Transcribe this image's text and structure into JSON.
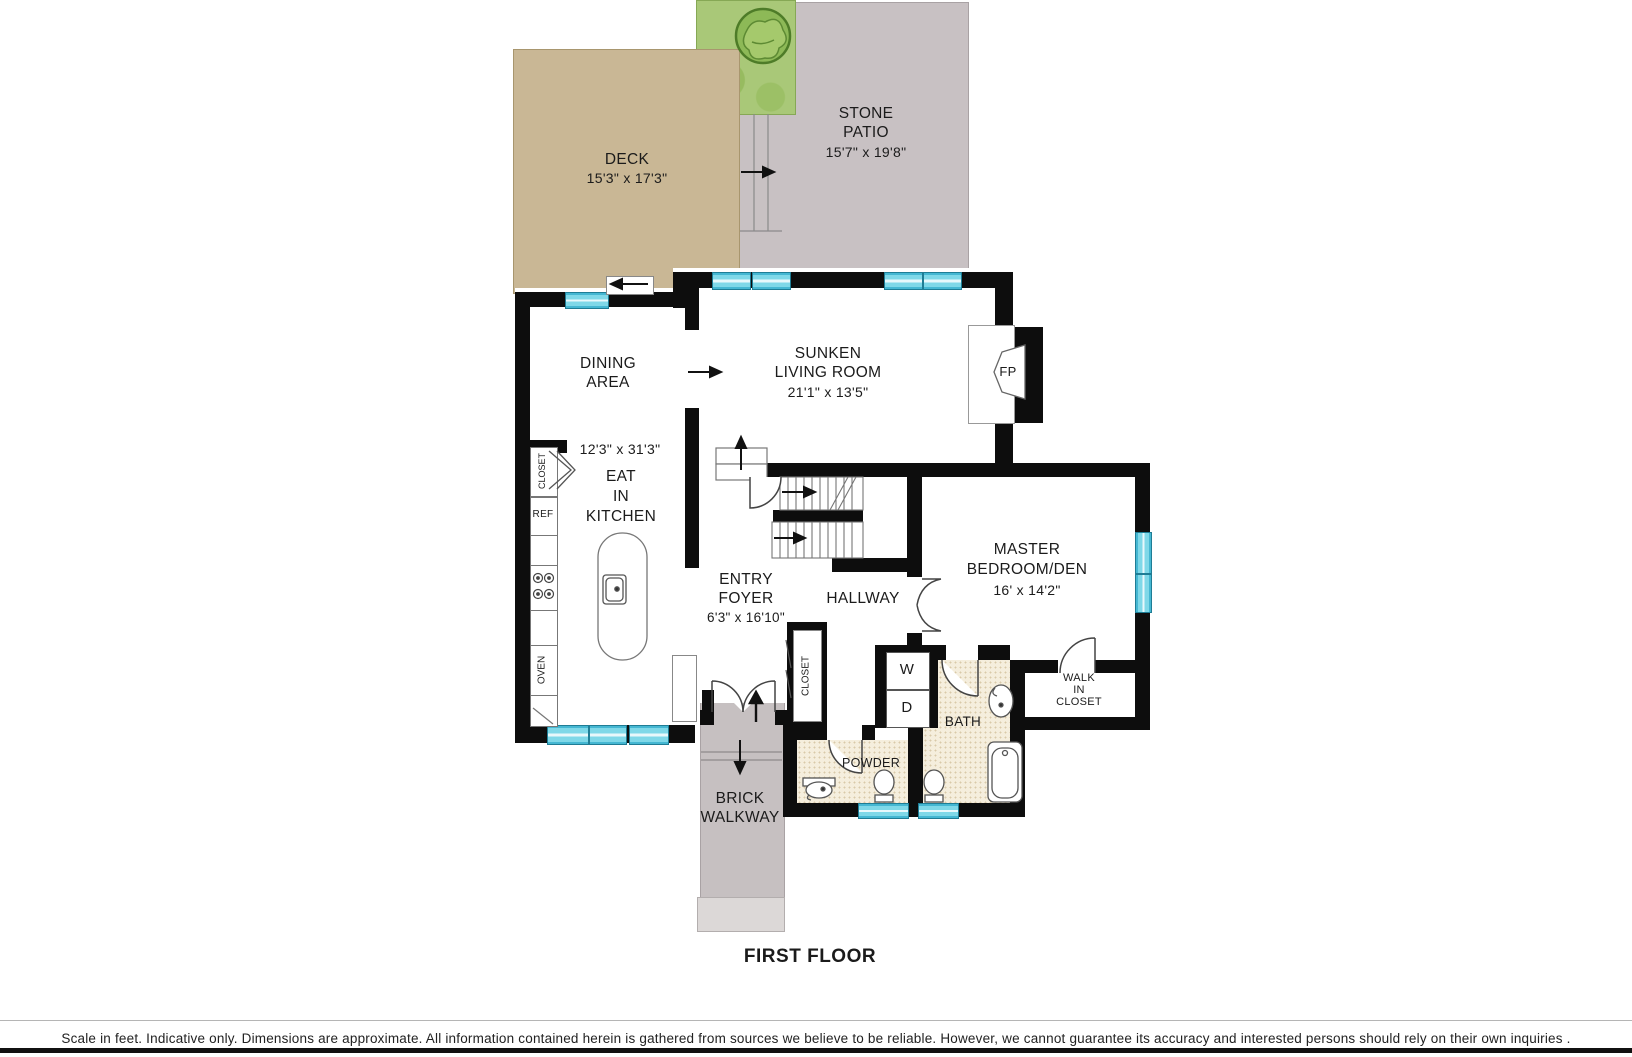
{
  "plan_title": "FIRST FLOOR",
  "disclaimer": "Scale in feet. Indicative only. Dimensions are approximate. All information contained herein is gathered from sources we believe to be reliable. However, we cannot guarantee its accuracy and interested persons should rely on their own inquiries .",
  "colors": {
    "wall": "#0d0d0d",
    "window": "#7fd8e8",
    "deck": "#c9b795",
    "patio": "#c8c1c3",
    "grass": "#a9c878",
    "walkway": "#c6c0c1",
    "bath_tile": "#f5eedd"
  },
  "areas": {
    "deck": {
      "name": "DECK",
      "dims": "15'3\" x 17'3\""
    },
    "stone_patio": {
      "lines": [
        "STONE",
        "PATIO"
      ],
      "dims": "15'7\" x 19'8\""
    },
    "dining": {
      "lines": [
        "DINING",
        "AREA"
      ]
    },
    "kitchen": {
      "dims": "12'3\" x 31'3\"",
      "lines": [
        "EAT",
        "IN",
        "KITCHEN"
      ]
    },
    "living": {
      "lines": [
        "SUNKEN",
        "LIVING ROOM"
      ],
      "dims": "21'1\" x 13'5\""
    },
    "entry_foyer": {
      "lines": [
        "ENTRY",
        "FOYER"
      ],
      "dims": "6'3\" x 16'10\""
    },
    "hallway": {
      "name": "HALLWAY"
    },
    "master": {
      "lines": [
        "MASTER",
        "BEDROOM/DEN"
      ],
      "dims": "16' x 14'2\""
    },
    "walk_in_closet": {
      "lines": [
        "WALK",
        "IN",
        "CLOSET"
      ]
    },
    "bath": {
      "name": "BATH"
    },
    "powder": {
      "name": "POWDER"
    },
    "brick_walkway": {
      "lines": [
        "BRICK",
        "WALKWAY"
      ]
    }
  },
  "labels": {
    "fireplace": "FP",
    "washer": "W",
    "dryer": "D",
    "refrigerator": "REF",
    "oven": "OVEN",
    "kitchen_closet": "CLOSET",
    "foyer_closet": "CLOSET"
  }
}
